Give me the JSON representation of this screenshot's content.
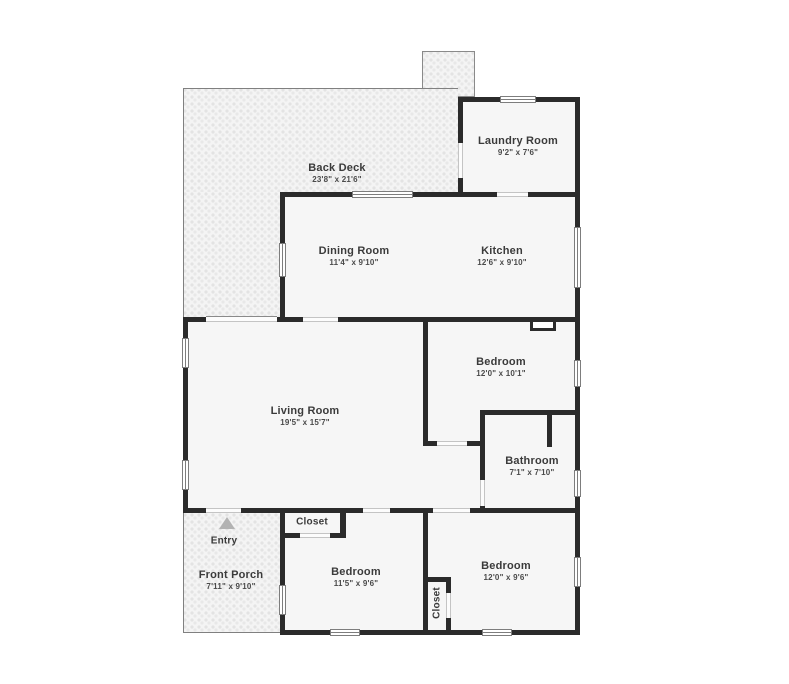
{
  "plan": {
    "type": "residential-floor-plan",
    "colors": {
      "wall": "#2b2b2b",
      "floor_fill": "#f6f6f6",
      "outdoor_fill": "#f4f4f4",
      "window_line": "#7d7d7d",
      "label_text": "#3b3b3b",
      "entry_arrow": "#b3b3b3",
      "background": "#ffffff"
    },
    "rooms": {
      "back_deck": {
        "name": "Back Deck",
        "dims": "23'8\" x 21'6\""
      },
      "laundry": {
        "name": "Laundry Room",
        "dims": "9'2\" x 7'6\""
      },
      "dining": {
        "name": "Dining Room",
        "dims": "11'4\" x 9'10\""
      },
      "kitchen": {
        "name": "Kitchen",
        "dims": "12'6\" x 9'10\""
      },
      "living": {
        "name": "Living Room",
        "dims": "19'5\" x 15'7\""
      },
      "bedroom_main": {
        "name": "Bedroom",
        "dims": "12'0\" x 10'1\""
      },
      "bathroom": {
        "name": "Bathroom",
        "dims": "7'1\" x 7'10\""
      },
      "closet_hall": {
        "name": "Closet"
      },
      "entry": {
        "name": "Entry"
      },
      "front_porch": {
        "name": "Front Porch",
        "dims": "7'11\" x 9'10\""
      },
      "bedroom_mid": {
        "name": "Bedroom",
        "dims": "11'5\" x 9'6\""
      },
      "closet_back": {
        "name": "Closet"
      },
      "bedroom_right": {
        "name": "Bedroom",
        "dims": "12'0\" x 9'6\""
      }
    }
  }
}
